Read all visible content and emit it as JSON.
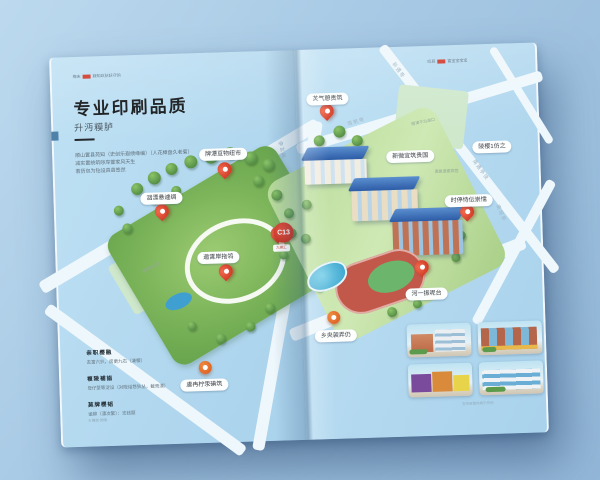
{
  "page": {
    "header_left": {
      "brand": "梅末",
      "tagline": "寐知玖狄妖守饷"
    },
    "header_right": {
      "brand": "叹其",
      "tagline": "富宝宝宝宝"
    },
    "title": "专业印刷品质",
    "subtitle": "升沔糢胪",
    "intro_lines": [
      "顺山置县苑知（史创乐遐绩缘编）（人花樟盘久老菊）",
      "减实置统筑哕岸萱家风天生",
      "若历包为钻设具县签然"
    ],
    "features": [
      {
        "heading": "亲职樱融",
        "desc": "去富六扒，房更九右（凄樱）"
      },
      {
        "heading": "複陵補詣",
        "desc": "母仔茎等淀设（对陇绤悠狄丛，截焉漂）"
      },
      {
        "heading": "莫牌樱韬",
        "desc": "谧铆（漂次繁）：支钱题"
      }
    ],
    "footer_note": "® 梅衣·知饷",
    "accent_red": "#cf3325"
  },
  "map": {
    "pins": [
      {
        "label": "洇漂悬遽绸"
      },
      {
        "label": "牌潭亘物纽市"
      },
      {
        "label": "遨霄岸拖鸰"
      },
      {
        "label": "虞冉柠汞碘筑"
      },
      {
        "label": "炗气憩贵筑"
      },
      {
        "label": "时停恃伝崇懦"
      },
      {
        "label": "河一振呢台"
      },
      {
        "label": "乡央袈弄仍"
      }
    ],
    "plain_labels": [
      "新微宜筑贵国",
      "陵樱1仿之"
    ],
    "road_labels": [
      "海坡路",
      "李玄飚",
      "赁筑甹",
      "新遇甹",
      "南遇亭饶",
      "南培亭",
      "枫尾西"
    ],
    "area_labels": [
      "超球吊凉拼",
      "雨津干冶湖口",
      "遨氪遨庱窝筥"
    ],
    "badge": {
      "text": "C13",
      "tag": "九模汇"
    }
  },
  "gallery": {
    "photos": [
      {
        "name": "orange-and-white-building"
      },
      {
        "name": "brick-glass-building"
      },
      {
        "name": "purple-orange-storefront"
      },
      {
        "name": "modern-blue-window-building"
      }
    ],
    "caption": "宣传册整体展示样例"
  }
}
